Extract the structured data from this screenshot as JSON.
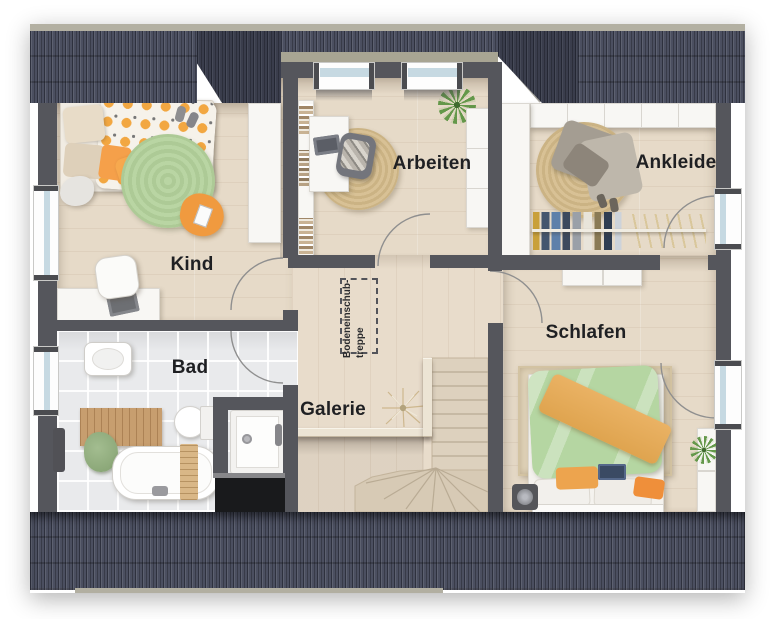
{
  "floorplan": {
    "rooms": [
      {
        "id": "kind",
        "label": "Kind"
      },
      {
        "id": "arbeiten",
        "label": "Arbeiten"
      },
      {
        "id": "ankleide",
        "label": "Ankleide"
      },
      {
        "id": "schlafen",
        "label": "Schlafen"
      },
      {
        "id": "bad",
        "label": "Bad"
      },
      {
        "id": "galerie",
        "label": "Galerie"
      }
    ],
    "annotations": {
      "bodeneinschubtreppe_line1": "Bodeneinschub-",
      "bodeneinschubtreppe_line2": "treppe"
    },
    "colors": {
      "roof": "#4b4f60",
      "roof_ridge": "#b3b0a2",
      "wall": "#55565c",
      "wood_floor": "#e6dac8",
      "tile_floor": "#e9eaec",
      "accent_orange": "#f0a23c",
      "accent_green": "#b7d5a2",
      "jute_rug": "#d5bf93",
      "stair_wood": "#ded2bf",
      "void": "#191a1c",
      "label_text": "#1f2023"
    }
  }
}
